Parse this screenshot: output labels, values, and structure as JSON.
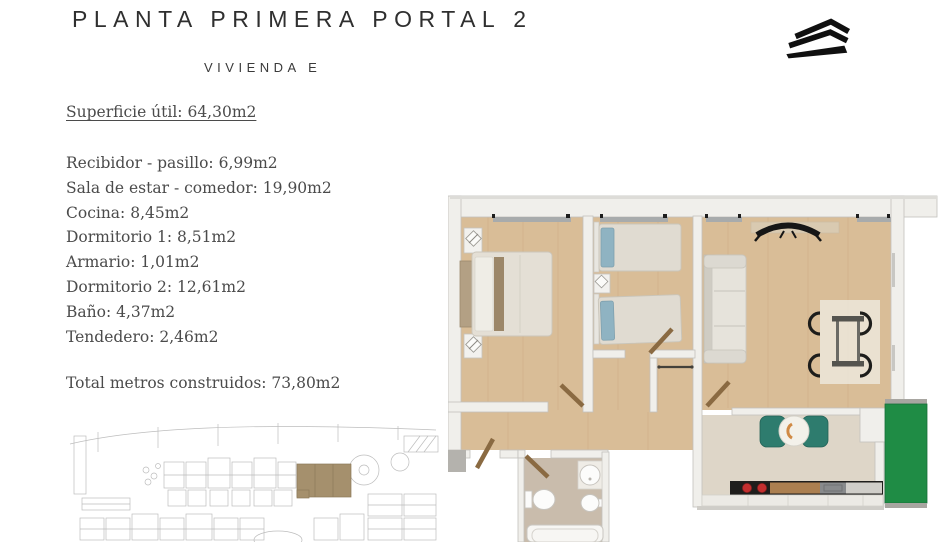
{
  "header": {
    "title": "PLANTA PRIMERA PORTAL 2",
    "subtitle": "VIVIENDA E"
  },
  "areas": {
    "superficie": "Superficie útil: 64,30m2",
    "rooms": [
      "Recibidor - pasillo: 6,99m2",
      "Sala de estar - comedor: 19,90m2",
      "Cocina: 8,45m2",
      "Dormitorio 1: 8,51m2",
      "Armario: 1,01m2",
      "Dormitorio 2: 12,61m2",
      "Baño: 4,37m2",
      "Tendedero: 2,46m2"
    ],
    "total": "Total metros construidos: 73,80m2"
  },
  "colors": {
    "logo_black": "#101010",
    "floor_wood": "#d9bd97",
    "kitchen_floor": "#ded6c8",
    "bath_floor": "#c9bcac",
    "tendedero_green": "#1f8c45",
    "chair_teal": "#2e7c6e",
    "door_wood": "#8a6a42",
    "wall_white": "#f0efeb",
    "highlight_brown": "#a5906d"
  }
}
